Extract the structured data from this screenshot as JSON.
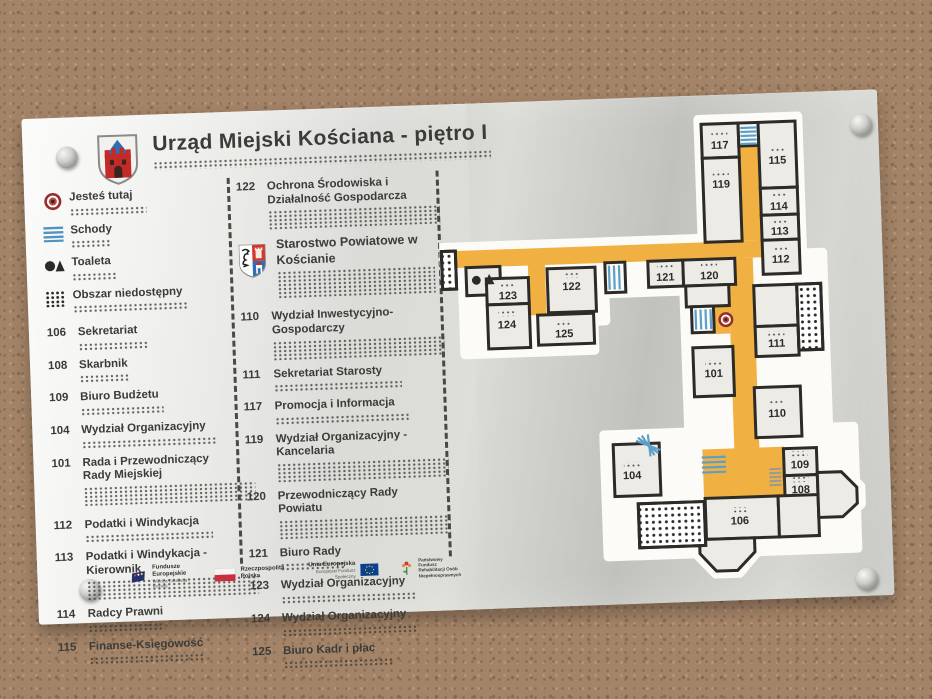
{
  "header": {
    "title": "Urząd Miejski Kościana - piętro I"
  },
  "legend": [
    {
      "icon": "you-are-here-icon",
      "label": "Jesteś tutaj"
    },
    {
      "icon": "stairs-icon",
      "label": "Schody"
    },
    {
      "icon": "toilet-icon",
      "label": "Toaleta"
    },
    {
      "icon": "inaccessible-area-icon",
      "label": "Obszar niedostępny"
    }
  ],
  "city_rooms": [
    {
      "number": "106",
      "label": "Sekretariat"
    },
    {
      "number": "108",
      "label": "Skarbnik"
    },
    {
      "number": "109",
      "label": "Biuro Budżetu"
    },
    {
      "number": "104",
      "label": "Wydział Organizacyjny"
    },
    {
      "number": "101",
      "label": "Rada i Przewodniczący Rady Miejskiej"
    },
    {
      "number": "112",
      "label": "Podatki i Windykacja"
    },
    {
      "number": "113",
      "label": "Podatki i Windykacja - Kierownik"
    },
    {
      "number": "114",
      "label": "Radcy Prawni"
    },
    {
      "number": "115",
      "label": "Finanse-Księgowość"
    }
  ],
  "county": {
    "first_room": {
      "number": "122",
      "label": "Ochrona Środowiska i Działalność Gospodarcza"
    },
    "heading": "Starostwo Powiatowe w Kościanie",
    "rooms": [
      {
        "number": "110",
        "label": "Wydział Inwestycyjno-Gospodarczy"
      },
      {
        "number": "111",
        "label": "Sekretariat Starosty"
      },
      {
        "number": "117",
        "label": "Promocja i Informacja"
      },
      {
        "number": "119",
        "label": "Wydział Organizacyjny - Kancelaria"
      },
      {
        "number": "120",
        "label": "Przewodniczący Rady Powiatu"
      },
      {
        "number": "121",
        "label": "Biuro Rady"
      },
      {
        "number": "123",
        "label": "Wydział Organizacyjny"
      },
      {
        "number": "124",
        "label": "Wydział Organizacyjny"
      },
      {
        "number": "125",
        "label": "Biuro Kadr i płac"
      }
    ]
  },
  "floorplan": {
    "rooms": [
      {
        "number": "117"
      },
      {
        "number": "115"
      },
      {
        "number": "119"
      },
      {
        "number": "114"
      },
      {
        "number": "113"
      },
      {
        "number": "112"
      },
      {
        "number": "121"
      },
      {
        "number": "120"
      },
      {
        "number": "122"
      },
      {
        "number": "123"
      },
      {
        "number": "124"
      },
      {
        "number": "125"
      },
      {
        "number": "111"
      },
      {
        "number": "101"
      },
      {
        "number": "110"
      },
      {
        "number": "104"
      },
      {
        "number": "109"
      },
      {
        "number": "108"
      },
      {
        "number": "106"
      }
    ]
  },
  "footer_logos": [
    {
      "name": "fundusze-europejskie",
      "line1": "Fundusze",
      "line2": "Europejskie",
      "sub": "Wiedza Edukacja Rozwój"
    },
    {
      "name": "rzeczpospolita-polska",
      "line1": "Rzeczpospolita",
      "line2": "Polska",
      "sub": ""
    },
    {
      "name": "unia-europejska",
      "line1": "Unia Europejska",
      "line2": "Europejski Fundusz Społeczny",
      "sub": ""
    },
    {
      "name": "pfron",
      "line1": "Państwowy Fundusz",
      "line2": "Rehabilitacji Osób",
      "line3": "Niepełnosprawnych"
    }
  ],
  "colors": {
    "corridor": "#f0b042",
    "stairs_blue": "#5d9fc7",
    "walls": "#2d2b27",
    "target_red": "#93302e",
    "plate": "#d6d6d2"
  }
}
